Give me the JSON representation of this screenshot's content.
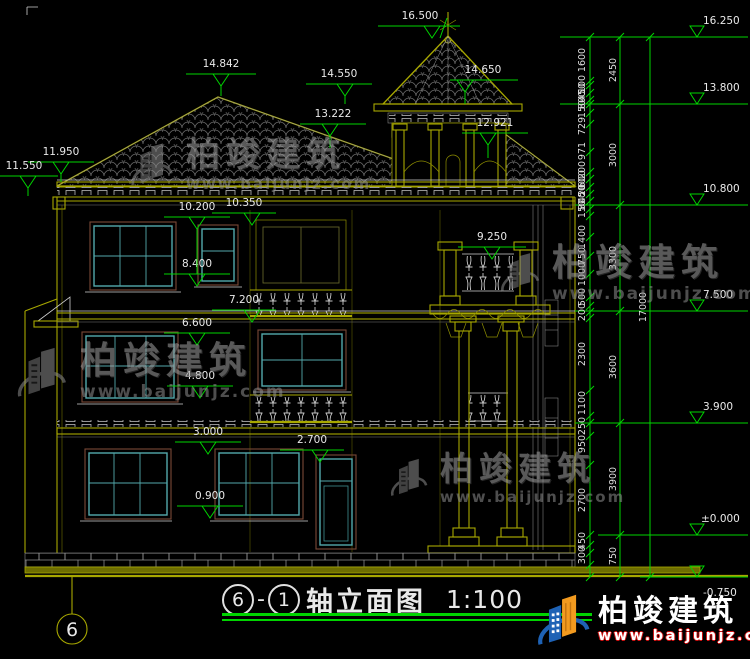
{
  "title": {
    "axis_a": "6",
    "sep": "-",
    "axis_b": "1",
    "label": "轴立面图",
    "scale": "1:100"
  },
  "axis_bubble": "6",
  "levels_left": [
    {
      "v": "16.500"
    },
    {
      "v": "14.842"
    },
    {
      "v": "14.550"
    },
    {
      "v": "14.650"
    },
    {
      "v": "13.222"
    },
    {
      "v": "12.921"
    },
    {
      "v": "11.950"
    },
    {
      "v": "11.550"
    },
    {
      "v": "10.200"
    },
    {
      "v": "10.350"
    },
    {
      "v": "8.400"
    },
    {
      "v": "9.250"
    },
    {
      "v": "7.200"
    },
    {
      "v": "6.600"
    },
    {
      "v": "4.800"
    },
    {
      "v": "3.000"
    },
    {
      "v": "2.700"
    },
    {
      "v": "0.900"
    }
  ],
  "levels_right": [
    {
      "v": "16.250"
    },
    {
      "v": "13.800"
    },
    {
      "v": "10.800"
    },
    {
      "v": "7.500"
    },
    {
      "v": "3.900"
    },
    {
      "v": "±0.000"
    },
    {
      "v": "-0.750"
    }
  ],
  "dims_inner": [
    {
      "v": "1600"
    },
    {
      "v": "100"
    },
    {
      "v": "450"
    },
    {
      "v": "800"
    },
    {
      "v": "150"
    },
    {
      "v": "729"
    },
    {
      "v": "971"
    },
    {
      "v": "200"
    },
    {
      "v": "600"
    },
    {
      "v": "200"
    },
    {
      "v": "450"
    },
    {
      "v": "800"
    },
    {
      "v": "150"
    },
    {
      "v": "1400"
    },
    {
      "v": "750"
    },
    {
      "v": "1000"
    },
    {
      "v": "500"
    },
    {
      "v": "200"
    },
    {
      "v": "2300"
    },
    {
      "v": "1100"
    },
    {
      "v": "250"
    },
    {
      "v": "950"
    },
    {
      "v": "2700"
    },
    {
      "v": "450"
    },
    {
      "v": "300"
    }
  ],
  "dims_outer": [
    {
      "v": "2450"
    },
    {
      "v": "3000"
    },
    {
      "v": "3300"
    },
    {
      "v": "3600"
    },
    {
      "v": "3900"
    },
    {
      "v": "750"
    }
  ],
  "dims_total": {
    "v": "17000"
  },
  "watermark": {
    "brand": "柏竣建筑",
    "url": "www.baijunjz.com"
  },
  "logo": {
    "brand": "柏竣建筑",
    "url": "www.baijunjz.com"
  },
  "colors": {
    "cad_line": "#a8a800",
    "dimension": "#00d400",
    "window": "#53a8ab",
    "frame": "#7a4836",
    "brand_blue": "#1e62b5",
    "brand_orange": "#f29a1f"
  }
}
